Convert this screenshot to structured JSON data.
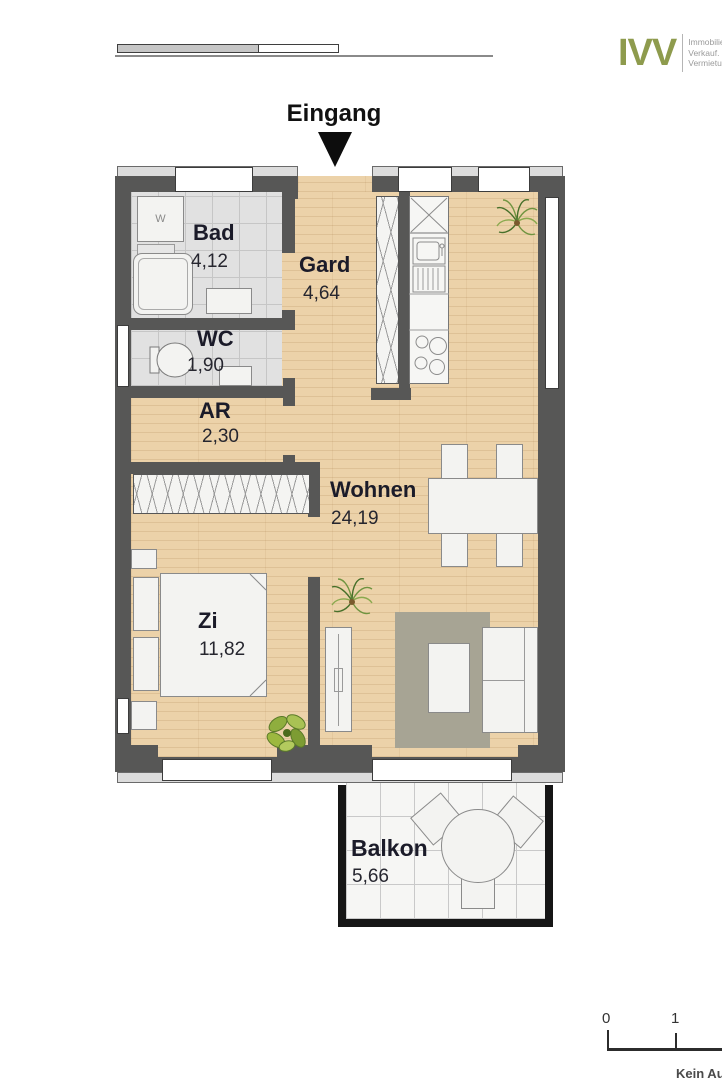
{
  "header": {
    "brand": "IVV",
    "tagline": [
      "Immobilien.",
      "Verkauf.",
      "Vermietung."
    ]
  },
  "entrance": {
    "label": "Eingang"
  },
  "rooms": {
    "bad": {
      "name": "Bad",
      "area": "4,12"
    },
    "gard": {
      "name": "Gard",
      "area": "4,64"
    },
    "wc": {
      "name": "WC",
      "area": "1,90"
    },
    "ar": {
      "name": "AR",
      "area": "2,30"
    },
    "wohnen": {
      "name": "Wohnen",
      "area": "24,19"
    },
    "zi": {
      "name": "Zi",
      "area": "11,82"
    },
    "balkon": {
      "name": "Balkon",
      "area": "5,66"
    }
  },
  "fixtures": {
    "washing_machine_label": "W"
  },
  "scale_bar": {
    "mark0": "0",
    "mark1": "1"
  },
  "footer": {
    "partial_text": "Kein Au"
  },
  "colors": {
    "wall": "#575756",
    "wood_floor": "#ecd2a9",
    "brand_olive": "#8e9b4d",
    "plant_green": "#7fa33c",
    "rug": "#a7a494"
  }
}
